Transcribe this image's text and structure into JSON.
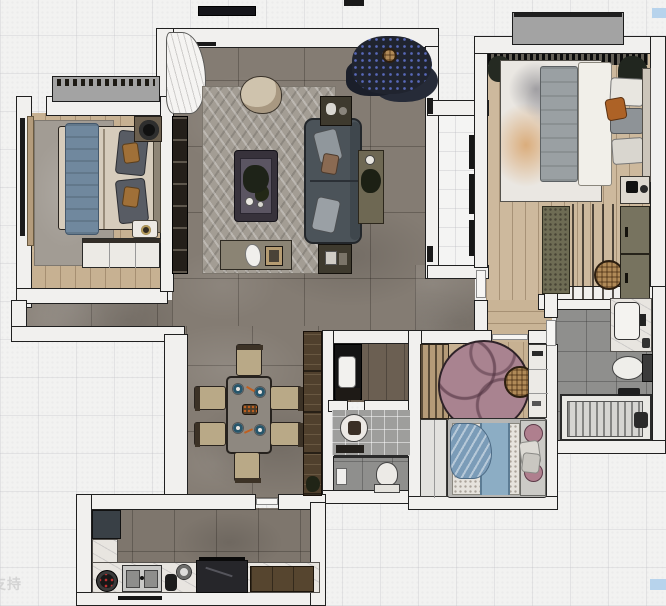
{
  "canvas": {
    "width": 666,
    "height": 606,
    "watermark": "支持",
    "markers": {
      "top_right_color": "#b7d3ec",
      "bottom_right_color": "#b7d3ec"
    }
  },
  "palette": {
    "background": "#f2f2f1",
    "wall_fill": "#f1f0ee",
    "wall_outline": "#202020",
    "tile_floor": "#847c73",
    "wood_floor": "#c7b192",
    "wood_floor_master": "#cdb99d",
    "living_rug": "#a39d94",
    "bedroom_rug": "#a29c94",
    "kids_rug_pink": "#a98390",
    "sofa": "#4b5359",
    "bed_blue_throw": "#70889e",
    "kids_bed_blue": "#8cadc4",
    "accent_orange_pillow": "#ad6226",
    "kitchen_marble": "#e8e5e0",
    "bathroom_tile": "#8f8f8d",
    "cabinet_brown": "#50402d",
    "balcony_slab": "#a3a3a3",
    "plant_dark": "#1d2230"
  },
  "inventory": {
    "living_room": [
      "curtain",
      "window",
      "tv-console",
      "herringbone-rug",
      "round-armchair",
      "coffee-table-plant",
      "sofa-with-pillows",
      "console-table",
      "side-table-north",
      "side-table-south",
      "decor-bench",
      "large-plant",
      "wall-sconces"
    ],
    "bedroom_left": [
      "bay-window",
      "window-curtain",
      "rug",
      "double-bed-blue-throw",
      "pillows",
      "nightstand-fan",
      "tray-nightstand",
      "built-in-wardrobe"
    ],
    "master_bedroom": [
      "balcony-slab",
      "curtain-band",
      "corner-plants",
      "abstract-rug",
      "double-bed",
      "orange-pillow",
      "nightstand",
      "foot-bench",
      "slatted-screen",
      "wicker-pouf",
      "wardrobe"
    ],
    "dining": [
      "dining-table",
      "six-chairs",
      "place-settings",
      "tall-sideboard-cabinet"
    ],
    "bathroom_center": [
      "vanity-counter",
      "vanity-sink",
      "round-basin-mirror",
      "shower-glass",
      "bath-mat",
      "toilet"
    ],
    "bathroom_right": [
      "washbasin-counter",
      "toilet",
      "bathtub",
      "faucet"
    ],
    "kids_bedroom": [
      "slat-wardrobe",
      "pink-round-rug",
      "wicker-stool",
      "shelf-cabinet",
      "wardrobe",
      "bed-blue-runner",
      "pink-round-pillows",
      "drape"
    ],
    "kitchen": [
      "fridge",
      "marble-counter",
      "gas-burner",
      "double-sink",
      "kettle",
      "pot",
      "cooktop-hood",
      "brown-cabinets",
      "window"
    ]
  }
}
